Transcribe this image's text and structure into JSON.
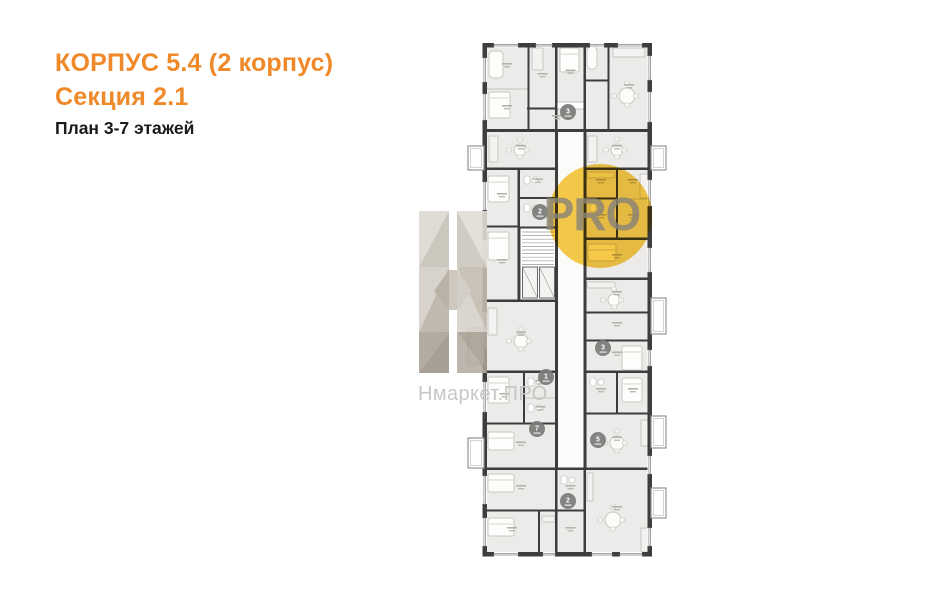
{
  "header": {
    "building_title": "КОРПУС 5.4 (2 корпус)",
    "section_title": "Секция 2.1",
    "plan_subtitle": "План 3-7 этажей",
    "accent_color": "#ef8929",
    "subtitle_color": "#1b1b1b"
  },
  "watermark": {
    "brand_text": "Нмаркет.ПРО",
    "brand_text_color": "#c8c7c5",
    "pro_badge_text": "PRO",
    "badge_color": "#f7c73e",
    "pro_text_color": "#8a8478",
    "logo_polys": [
      [
        "419,211 449,211 419,267",
        "#dcd8d1"
      ],
      [
        "449,211 449,267 419,267",
        "#c7c1b6"
      ],
      [
        "419,267 449,267 419,332",
        "#d3cec6"
      ],
      [
        "449,267 449,332 419,332",
        "#b9b2a6"
      ],
      [
        "419,332 449,332 419,373",
        "#aba295"
      ],
      [
        "449,332 449,373 419,373",
        "#9e9588"
      ],
      [
        "457,211 487,211 487,267",
        "#e1ddd7"
      ],
      [
        "457,211 457,267 487,267",
        "#cdc7bd"
      ],
      [
        "457,267 487,267 487,332",
        "#c3bcb0"
      ],
      [
        "457,267 457,332 487,332",
        "#d6d1c9"
      ],
      [
        "457,332 487,332 487,373",
        "#a89f93"
      ],
      [
        "457,332 457,373 487,373",
        "#b6aea2"
      ],
      [
        "449,270 457,270 457,310 449,310",
        "#c8c2b8"
      ],
      [
        "434,291 449,270 449,310",
        "#b2aa9d"
      ],
      [
        "457,270 472,291 457,310",
        "#cfc9bf"
      ]
    ]
  },
  "floorplan": {
    "wall_color": "#3d3d3d",
    "room_fill": "#ecebe9",
    "partition_color": "#c2c0bc",
    "furniture_color": "#c9c7c3",
    "label_dash_color": "#b4b2ae",
    "corridor": [
      556,
      131,
      29,
      338
    ],
    "rooms": [
      [
        485,
        47,
        44,
        42
      ],
      [
        485,
        89,
        44,
        42
      ],
      [
        529,
        47,
        27,
        62
      ],
      [
        556,
        47,
        29,
        55
      ],
      [
        585,
        47,
        24,
        34
      ],
      [
        609,
        47,
        40,
        84
      ],
      [
        529,
        109,
        56,
        22
      ],
      [
        585,
        81,
        24,
        50
      ],
      [
        485,
        131,
        72,
        38
      ],
      [
        585,
        131,
        64,
        38
      ],
      [
        485,
        169,
        34,
        58
      ],
      [
        485,
        227,
        34,
        74
      ],
      [
        519,
        169,
        38,
        29
      ],
      [
        519,
        198,
        38,
        29
      ],
      [
        585,
        169,
        32,
        30
      ],
      [
        617,
        169,
        32,
        30
      ],
      [
        585,
        199,
        32,
        40
      ],
      [
        617,
        199,
        32,
        40
      ],
      [
        585,
        239,
        64,
        40
      ],
      [
        485,
        301,
        72,
        71
      ],
      [
        585,
        279,
        64,
        34
      ],
      [
        585,
        313,
        64,
        28
      ],
      [
        585,
        341,
        64,
        31
      ],
      [
        485,
        372,
        39,
        52
      ],
      [
        524,
        372,
        33,
        26
      ],
      [
        524,
        398,
        33,
        26
      ],
      [
        485,
        424,
        72,
        45
      ],
      [
        585,
        372,
        32,
        42
      ],
      [
        617,
        372,
        32,
        42
      ],
      [
        585,
        414,
        64,
        55
      ],
      [
        485,
        469,
        72,
        42
      ],
      [
        485,
        511,
        54,
        42
      ],
      [
        539,
        511,
        18,
        42
      ],
      [
        556,
        469,
        29,
        42
      ],
      [
        556,
        511,
        29,
        42
      ],
      [
        585,
        469,
        64,
        84
      ]
    ],
    "walls": [
      [
        482.5,
        43,
        169.5,
        4.5
      ],
      [
        482.5,
        552,
        169.5,
        4.5
      ],
      [
        482.5,
        43,
        4.5,
        513.5
      ],
      [
        647.5,
        43,
        4.5,
        513.5
      ],
      [
        484,
        129,
        166,
        3
      ],
      [
        484,
        167.5,
        73,
        2.5
      ],
      [
        584,
        167.5,
        66,
        2.5
      ],
      [
        484,
        225.5,
        36,
        2
      ],
      [
        519,
        197,
        38,
        2
      ],
      [
        527,
        107.5,
        30,
        2
      ],
      [
        584,
        79.5,
        25,
        2
      ],
      [
        584,
        197.5,
        34,
        2
      ],
      [
        584,
        237.5,
        66,
        2.5
      ],
      [
        584,
        277.5,
        66,
        2.5
      ],
      [
        584,
        311.5,
        66,
        2
      ],
      [
        584,
        339.5,
        66,
        2
      ],
      [
        484,
        299.5,
        74,
        2.5
      ],
      [
        484,
        370.5,
        74,
        2.5
      ],
      [
        584,
        370.5,
        66,
        2.5
      ],
      [
        484,
        422.5,
        74,
        2
      ],
      [
        584,
        412.5,
        66,
        2
      ],
      [
        484,
        467.5,
        74,
        2.5
      ],
      [
        584,
        467.5,
        66,
        2.5
      ],
      [
        556,
        467.5,
        30,
        2.5
      ],
      [
        484,
        509.5,
        73,
        2
      ],
      [
        556,
        509.5,
        29,
        2
      ],
      [
        519,
        226.5,
        38,
        2
      ],
      [
        519,
        300,
        38,
        2
      ],
      [
        527.5,
        47,
        2,
        82
      ],
      [
        555,
        47,
        2.5,
        84
      ],
      [
        583.5,
        47,
        2.5,
        84
      ],
      [
        607.5,
        47,
        2,
        84
      ],
      [
        555,
        131,
        3,
        338
      ],
      [
        583.5,
        131,
        3,
        338
      ],
      [
        517.5,
        169,
        2.5,
        131
      ],
      [
        616,
        169,
        2,
        70
      ],
      [
        616,
        372,
        2,
        42
      ],
      [
        523,
        372,
        2,
        52
      ],
      [
        538,
        511,
        2,
        41
      ],
      [
        555,
        469,
        2.5,
        85
      ],
      [
        583.5,
        469,
        2.5,
        85
      ]
    ],
    "windows": [
      [
        482.5,
        58,
        24,
        "v"
      ],
      [
        482.5,
        94,
        26,
        "v"
      ],
      [
        482.5,
        182,
        28,
        "v"
      ],
      [
        482.5,
        240,
        28,
        "v"
      ],
      [
        482.5,
        312,
        36,
        "v"
      ],
      [
        482.5,
        382,
        30,
        "v"
      ],
      [
        482.5,
        476,
        28,
        "v"
      ],
      [
        482.5,
        518,
        28,
        "v"
      ],
      [
        647.5,
        56,
        24,
        "v"
      ],
      [
        647.5,
        92,
        30,
        "v"
      ],
      [
        647.5,
        180,
        26,
        "v"
      ],
      [
        647.5,
        248,
        24,
        "v"
      ],
      [
        647.5,
        350,
        16,
        "v"
      ],
      [
        647.5,
        456,
        18,
        "v"
      ],
      [
        647.5,
        528,
        18,
        "v"
      ],
      [
        494,
        43,
        24,
        "h"
      ],
      [
        536,
        43,
        16,
        "h"
      ],
      [
        590,
        43,
        14,
        "h"
      ],
      [
        618,
        43,
        24,
        "h"
      ],
      [
        494,
        552,
        24,
        "h"
      ],
      [
        543,
        552,
        12,
        "h"
      ],
      [
        592,
        552,
        20,
        "h"
      ],
      [
        620,
        552,
        22,
        "h"
      ]
    ],
    "balconies": [
      [
        468,
        146,
        16,
        24
      ],
      [
        468,
        328,
        16,
        36
      ],
      [
        468,
        438,
        16,
        30
      ],
      [
        651,
        146,
        15,
        24
      ],
      [
        651,
        298,
        15,
        36
      ],
      [
        651,
        416,
        15,
        32
      ],
      [
        651,
        488,
        15,
        30
      ]
    ],
    "stairs": {
      "box": [
        520,
        228,
        36,
        73
      ],
      "lifts": [
        [
          522.5,
          267,
          15,
          31
        ],
        [
          539.5,
          267,
          15,
          31
        ]
      ]
    },
    "furniture": [
      [
        "tub",
        489,
        51,
        14,
        27
      ],
      [
        "bed",
        489,
        92,
        21,
        26
      ],
      [
        "wardrobe",
        532,
        48,
        11,
        22
      ],
      [
        "bed",
        560,
        48,
        19,
        24
      ],
      [
        "tub",
        587,
        47,
        10,
        22
      ],
      [
        "sofa",
        613,
        48,
        32,
        9
      ],
      [
        "table",
        627,
        96,
        8
      ],
      [
        "sofa",
        489,
        136,
        9,
        26
      ],
      [
        "table",
        520,
        150,
        6
      ],
      [
        "sofa",
        588,
        136,
        9,
        26
      ],
      [
        "table",
        617,
        150,
        6
      ],
      [
        "bed",
        488,
        176,
        21,
        26
      ],
      [
        "wc",
        524,
        176
      ],
      [
        "wc",
        524,
        204
      ],
      [
        "counter",
        587,
        172,
        28,
        6
      ],
      [
        "wc",
        590,
        204
      ],
      [
        "wardrobe",
        640,
        174,
        8,
        24
      ],
      [
        "bed",
        588,
        244,
        28,
        17
      ],
      [
        "bed",
        488,
        232,
        21,
        28
      ],
      [
        "sofa",
        488,
        308,
        9,
        27
      ],
      [
        "table",
        521,
        341,
        7
      ],
      [
        "counter",
        587,
        282,
        28,
        6
      ],
      [
        "table",
        614,
        300,
        6
      ],
      [
        "bed",
        622,
        346,
        20,
        24
      ],
      [
        "bed",
        488,
        377,
        21,
        26
      ],
      [
        "wc",
        528,
        378
      ],
      [
        "wc",
        528,
        404
      ],
      [
        "wc",
        590,
        378
      ],
      [
        "bed",
        622,
        378,
        20,
        24
      ],
      [
        "bed",
        488,
        432,
        26,
        18
      ],
      [
        "table",
        617,
        443,
        7
      ],
      [
        "sofa",
        641,
        420,
        8,
        26
      ],
      [
        "bed",
        488,
        474,
        26,
        18
      ],
      [
        "bed",
        488,
        518,
        26,
        18
      ],
      [
        "counter",
        587,
        473,
        6,
        28
      ],
      [
        "table",
        613,
        520,
        8
      ],
      [
        "sofa",
        641,
        528,
        8,
        24
      ],
      [
        "counter",
        542,
        516,
        13,
        6
      ],
      [
        "wc",
        561,
        476
      ]
    ],
    "badges": [
      [
        568,
        112,
        "3"
      ],
      [
        540,
        212,
        "2"
      ],
      [
        546,
        377,
        "1"
      ],
      [
        603,
        348,
        "3"
      ],
      [
        537,
        429,
        "7"
      ],
      [
        598,
        440,
        "5"
      ],
      [
        568,
        501,
        "2"
      ]
    ]
  }
}
